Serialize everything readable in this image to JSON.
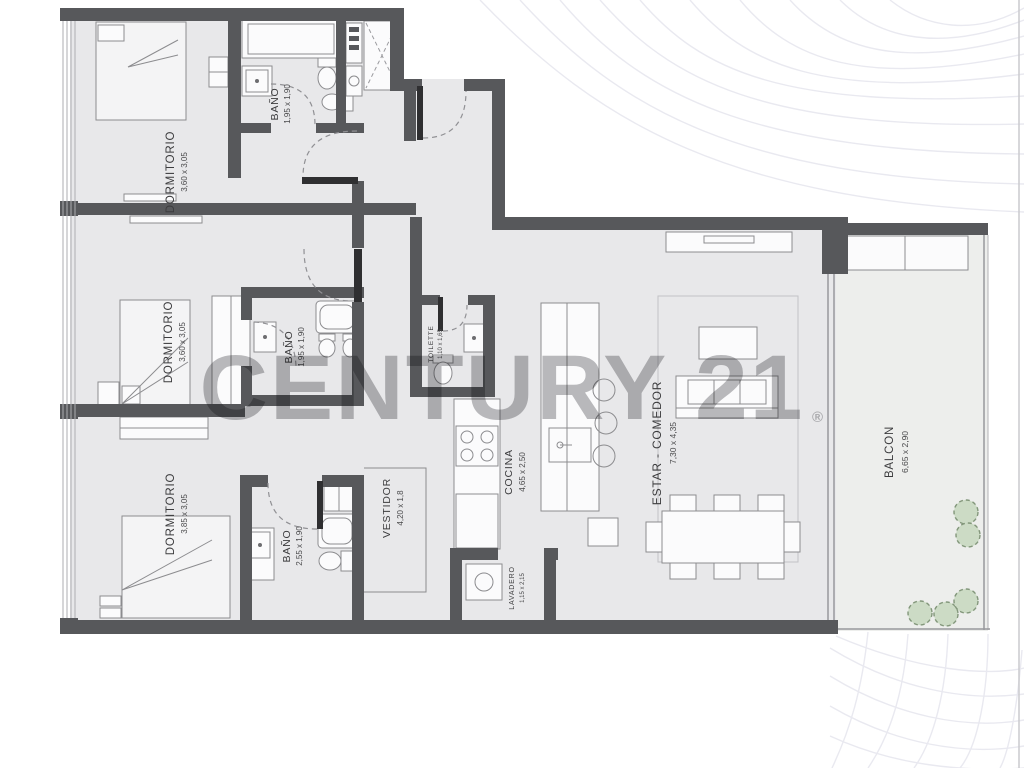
{
  "watermark": {
    "text": "CENTURY 21",
    "registered": "®",
    "color": "#828286"
  },
  "rooms": {
    "dormitorio_top": {
      "name": "DORMITORIO",
      "dims": "3,60 x 3,05"
    },
    "bano_top": {
      "name": "BAÑO",
      "dims": "1,95 x 1,90"
    },
    "dormitorio_mid": {
      "name": "DORMITORIO",
      "dims": "3,60 x 3,05"
    },
    "bano_mid": {
      "name": "BAÑO",
      "dims": "1,95 x 1,90"
    },
    "dormitorio_bottom": {
      "name": "DORMITORIO",
      "dims": "3,85 x 3,05"
    },
    "bano_bottom": {
      "name": "BAÑO",
      "dims": "2,55 x 1,90"
    },
    "vestidor": {
      "name": "VESTIDOR",
      "dims": "4,20 x 1,8"
    },
    "toilette": {
      "name": "TOILETTE",
      "dims": "1,10 x 1,65"
    },
    "cocina": {
      "name": "COCINA",
      "dims": "4,65 x 2,50"
    },
    "lavadero": {
      "name": "LAVADERO",
      "dims": "1,15 x 2,15"
    },
    "estar_comedor": {
      "name": "ESTAR - COMEDOR",
      "dims": "7,30 x 4,35"
    },
    "balcon": {
      "name": "BALCON",
      "dims": "6,65 x 2,90"
    }
  },
  "colors": {
    "wall": "#57585b",
    "floor": "#e8e8ea",
    "plant_fill": "#ccdbc5",
    "watermark": "#828286"
  }
}
